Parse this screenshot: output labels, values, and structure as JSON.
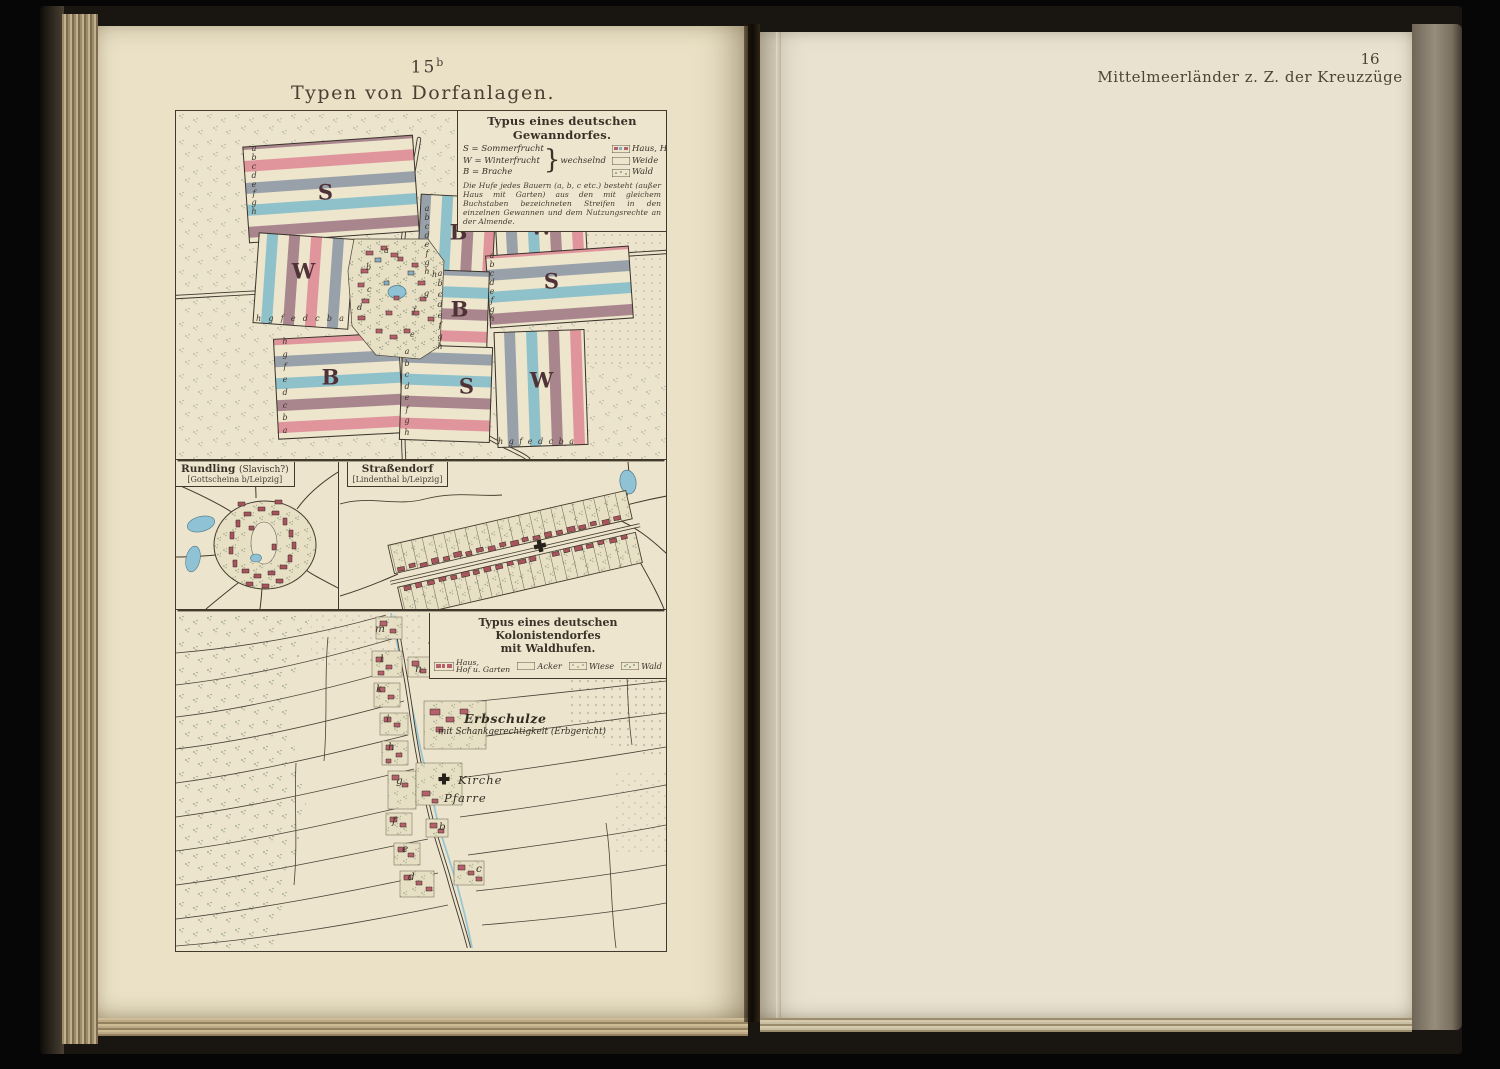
{
  "palette": {
    "page_left": "#eae1c6",
    "page_right": "#e9e2d0",
    "map_bg": "#ece4cc",
    "stripe_teal": "#8fc1ca",
    "stripe_mauve": "#a9868e",
    "stripe_pink": "#e0959d",
    "stripe_gray": "#98a1aa",
    "stripe_cream": "#ede5cc",
    "house_red": "#b4616b",
    "house_blue": "#86aec6",
    "water_blue": "#8ec2d4",
    "ink": "#3c342b"
  },
  "left_page": {
    "plate_number": "15",
    "plate_suffix": "b",
    "title": "Typen von Dorfanlagen."
  },
  "right_page": {
    "page_number": "16",
    "header": "Mittelmeerländer z. Z. der Kreuzzüge"
  },
  "brace_glyph": "}",
  "gewanndorf": {
    "legend": {
      "title": "Typus eines deutschen Gewanndorfes.",
      "crop_rows": [
        "S = Sommerfrucht",
        "W = Winterfrucht",
        "B = Brache"
      ],
      "crop_brace_label": "wechselnd",
      "area_rows": [
        "Haus, Hof u. Garten",
        "Weide",
        "Wald"
      ],
      "area_brace_label": "Almende",
      "note": "Die Hufe jedes Bauern (a, b, c etc.) besteht (außer Haus mit Garten) aus den mit gleichem Buchstaben bezeichneten Streifen in den einzelnen Gewannen und dem Nutzungsrechte an der Almende."
    },
    "block_letters": {
      "b1": "S",
      "b2": "B",
      "b3": "W",
      "b4": "W",
      "b5": "S",
      "b6": "B",
      "b7": "B",
      "b8": "S",
      "b9": "W"
    },
    "strip_letters": {
      "s_top_left_edge": "abcdefgh",
      "w_left_bottom": "hgfedcba",
      "w_top_right_top": "hgfedcba",
      "b_top_mid_edge": "abcdefgh",
      "s_right_edge": "abcdefgh",
      "b_center_edge": "abcdefgh",
      "b_bottom_left_edge": "hgfedcba",
      "s_bottom_edge": "abcdefgh",
      "w_bottom_right_bottom": "hgfedcba"
    },
    "village_letters": [
      "a",
      "b",
      "c",
      "d",
      "e",
      "f",
      "g",
      "h"
    ]
  },
  "rundling": {
    "title": "Rundling",
    "title_note": "(Slavisch?)",
    "subtitle": "[Gottscheina b/Leipzig]"
  },
  "strassendorf": {
    "title": "Straßendorf",
    "subtitle": "[Lindenthal b/Leipzig]"
  },
  "kolonistendorf": {
    "legend": {
      "title_line1": "Typus eines deutschen Kolonistendorfes",
      "title_line2": "mit Waldhufen.",
      "items": [
        {
          "l1": "Haus,",
          "l2": "Hof u. Garten"
        },
        {
          "l1": "Acker"
        },
        {
          "l1": "Wiese"
        },
        {
          "l1": "Wald"
        }
      ]
    },
    "labels": {
      "erbschulze": "Erbschulze",
      "erbschulze_sub": "mit Schankgerechtigkeit (Erbgericht)",
      "kirche": "Kirche",
      "pfarre": "Pfarre"
    },
    "road_letters_left": [
      "m",
      "l",
      "k",
      "i",
      "h",
      "g",
      "f",
      "e",
      "d"
    ],
    "road_letters_right": [
      "n",
      "b",
      "c"
    ]
  }
}
